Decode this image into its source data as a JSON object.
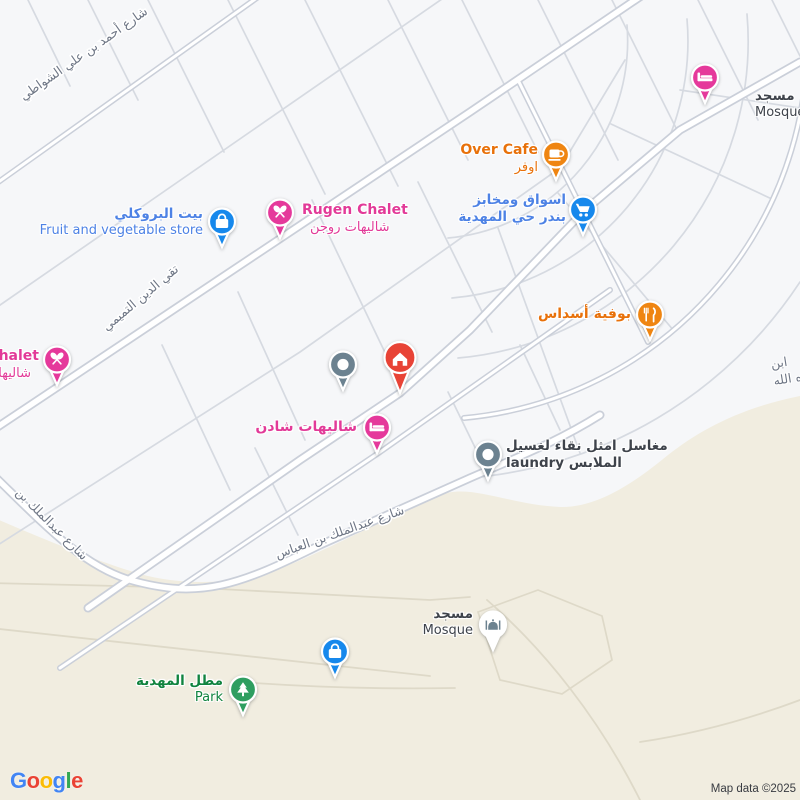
{
  "attribution": "Map data ©2025",
  "brand": {
    "letters": [
      "G",
      "o",
      "o",
      "g",
      "l",
      "e"
    ]
  },
  "streets": {
    "shawati": "شارع أحمد بن علي الشواطي",
    "tamimi": "تقي الدين التميمي",
    "abdulmalik_left": "شارع عبدالملك بن",
    "abbas": "شارع عبدالملك بن العباس",
    "edge_fragment_1": "ابن",
    "edge_fragment_2": "ه الله"
  },
  "pois": {
    "mosque_top": {
      "title": "مسجد",
      "subtitle": "Mosque"
    },
    "over_cafe": {
      "title": "Over Cafe",
      "subtitle": "اوفر"
    },
    "market": {
      "title": "اسواق ومخابز",
      "subtitle": "بندر حي المهدية"
    },
    "rugen": {
      "title": "Rugen Chalet",
      "subtitle": "شاليهات روجن"
    },
    "broccoli": {
      "title": "بيت البروكلي",
      "subtitle": "Fruit and vegetable store"
    },
    "chalet_left": {
      "title": "halet",
      "subtitle": "شاليها"
    },
    "asdas": {
      "title": "بوفية أسداس"
    },
    "shaden": {
      "title": "شاليهات شادن"
    },
    "laundry": {
      "title": "مغاسل امثل نقاء لغسيل",
      "subtitle": "laundry الملابس"
    },
    "mosque_bottom": {
      "title": "مسجد",
      "subtitle": "Mosque"
    },
    "park": {
      "title": "مطل المهدية",
      "subtitle": "Park"
    }
  },
  "icons": {
    "hotel_top": "bed-icon",
    "over_cafe": "coffee-cup-icon",
    "market": "shopping-cart-icon",
    "rugen": "chalet-icon",
    "broccoli": "shopping-bag-icon",
    "chalet_left": "chalet-icon",
    "asdas": "fork-knife-icon",
    "generic_dot": "dot-icon",
    "home": "house-icon",
    "shaden": "bed-icon",
    "laundry": "dot-icon",
    "mosque_bottom": "mosque-icon",
    "bag_bottom": "shopping-bag-icon",
    "park": "tree-icon"
  },
  "colors": {
    "pink": "#e5399b",
    "orange": "#ef8511",
    "blue-marker": "#1688ec",
    "red": "#e84336",
    "slate": "#6c8290",
    "green-marker": "#2e9e60",
    "label-food": "#e8710a",
    "label-shop": "#4d82e5",
    "label-lodging": "#e23a98",
    "label-green": "#10833f",
    "label-dark": "#3e434b",
    "street": "#6e7685",
    "beige": "#f1ede0",
    "block": "#f6f7f9",
    "road-minor": "#d6dae1",
    "road-minor-beige": "#ded9c8",
    "casing": "#cacfd9",
    "attr": "#383b41",
    "g0": "#4285F4",
    "g1": "#EA4335",
    "g2": "#FBBC05",
    "g3": "#4285F4",
    "g4": "#34A853",
    "g5": "#EA4335"
  }
}
